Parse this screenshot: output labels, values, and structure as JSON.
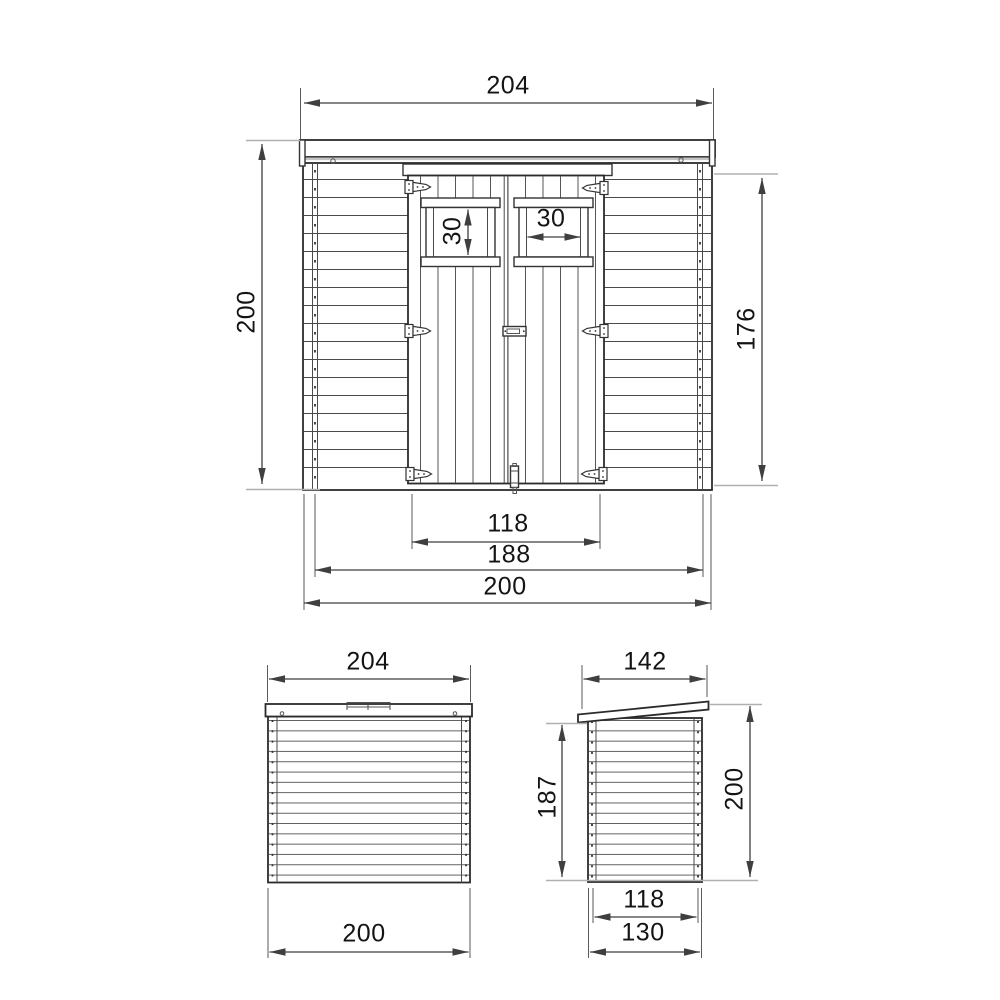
{
  "title": "Wooden shed technical drawing",
  "views": {
    "front": {
      "dimensions": {
        "roof_width": "204",
        "overall_height": "200",
        "wall_height": "176",
        "window_opening_height": "30",
        "window_opening_width": "30",
        "door_width": "118",
        "inner_wall_width": "188",
        "base_width": "200"
      }
    },
    "back": {
      "dimensions": {
        "roof_width": "204",
        "base_width": "200"
      }
    },
    "side": {
      "dimensions": {
        "roof_depth": "142",
        "wall_height": "187",
        "overall_height": "200",
        "inner_base_depth": "118",
        "base_depth": "130"
      }
    }
  },
  "colors": {
    "background": "#ffffff",
    "line": "#2b2b2b",
    "dimension_line": "#3f3f3f",
    "extension_line": "#b0b0b0",
    "text": "#141414"
  }
}
